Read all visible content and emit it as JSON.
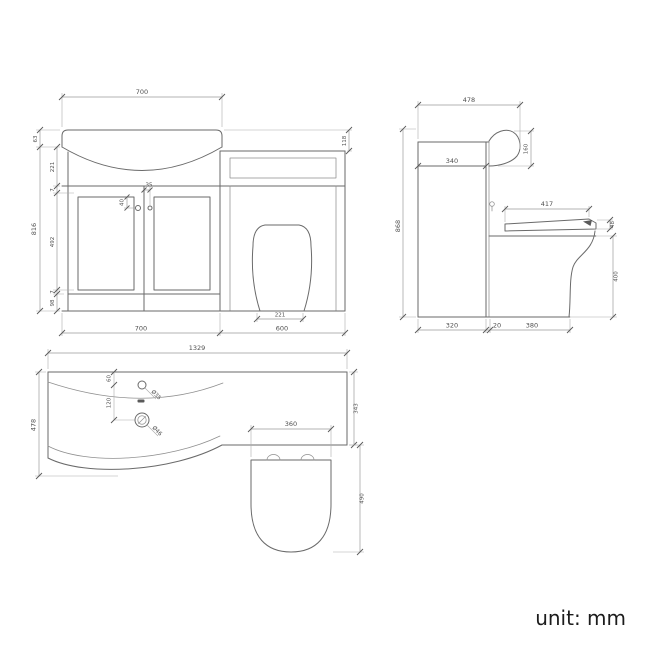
{
  "colors": {
    "background": "#ffffff",
    "line": "#6a6a6a",
    "line-light": "#8f8f8f",
    "dim-line": "#9a9a9a",
    "ext-line": "#ababab",
    "tick": "#5a5a5a",
    "dim-text": "#4f4f4f",
    "footer-text": "#1c1c1c"
  },
  "footer": {
    "unit_label": "unit: mm"
  },
  "views": {
    "front": {
      "dims": {
        "top_width": "700",
        "rim_height": "63",
        "overall_height": "816",
        "bowl_depth": "221",
        "trim_top": "7",
        "door_height": "492",
        "trim_bottom": "7",
        "plinth_height": "98",
        "knob_drop": "40",
        "knob_offset": "35",
        "wc_top_drop": "118",
        "pan_base_width": "221",
        "cabinet_width": "700",
        "wc_unit_width": "600"
      }
    },
    "side": {
      "dims": {
        "overall_depth": "478",
        "overall_height": "868",
        "ledge_depth": "340",
        "basin_height": "160",
        "seat_length": "417",
        "seat_thickness": "48",
        "pan_height": "400",
        "cabinet_depth": "320",
        "gap": "20",
        "pan_depth": "380"
      }
    },
    "plan": {
      "dims": {
        "overall_width": "1329",
        "vanity_depth": "478",
        "tap_setback": "60",
        "tap_to_waste": "120",
        "tap_hole_diameter": "Ø35",
        "waste_diameter": "Ø46",
        "wc_depth": "343",
        "seat_width": "360",
        "seat_projection": "490"
      }
    }
  }
}
